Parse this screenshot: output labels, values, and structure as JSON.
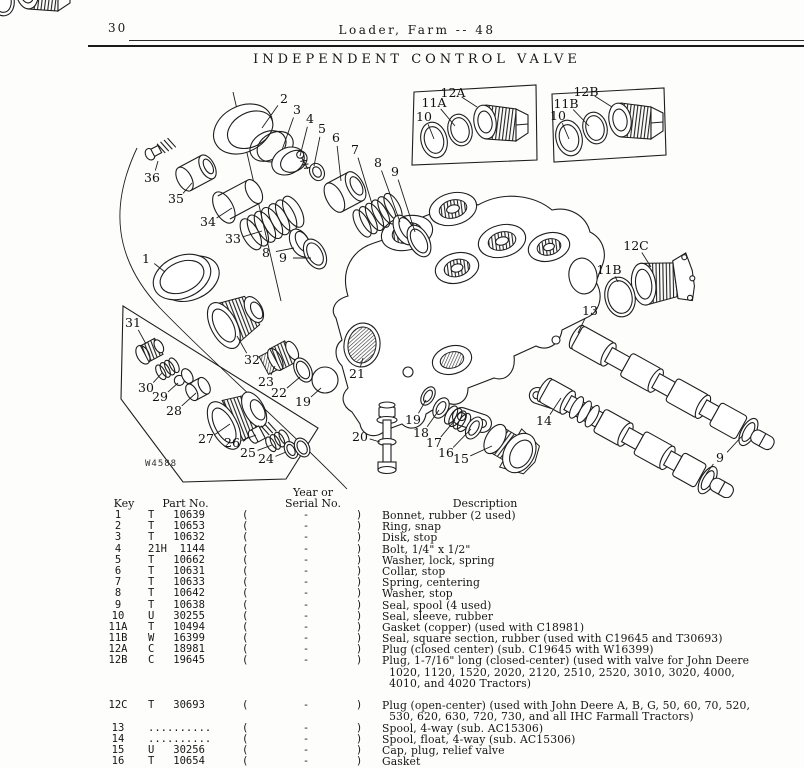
{
  "header": {
    "page_number": "30",
    "title": "Loader, Farm -- 48",
    "subtitle": "INDEPENDENT CONTROL VALVE"
  },
  "figure": {
    "figure_number": "W4588",
    "labels": [
      {
        "t": "2",
        "x": 284,
        "y": 103,
        "tx": 262,
        "ty": 128
      },
      {
        "t": "3",
        "x": 297,
        "y": 114,
        "tx": 282,
        "ty": 150
      },
      {
        "t": "4",
        "x": 310,
        "y": 123,
        "tx": 300,
        "ty": 156
      },
      {
        "t": "5",
        "x": 322,
        "y": 133,
        "tx": 314,
        "ty": 166
      },
      {
        "t": "6",
        "x": 336,
        "y": 142,
        "tx": 341,
        "ty": 181
      },
      {
        "t": "7",
        "x": 355,
        "y": 154,
        "tx": 372,
        "ty": 204
      },
      {
        "t": "8",
        "x": 378,
        "y": 167,
        "tx": 400,
        "ty": 222
      },
      {
        "t": "9",
        "x": 395,
        "y": 176,
        "tx": 415,
        "ty": 232
      },
      {
        "t": "36",
        "x": 152,
        "y": 182,
        "tx": 158,
        "ty": 161
      },
      {
        "t": "35",
        "x": 176,
        "y": 203,
        "tx": 192,
        "ty": 183
      },
      {
        "t": "34",
        "x": 208,
        "y": 226,
        "tx": 232,
        "ty": 208
      },
      {
        "t": "33",
        "x": 233,
        "y": 243,
        "tx": 262,
        "ty": 231
      },
      {
        "t": "8",
        "x": 266,
        "y": 257,
        "tx": 294,
        "ty": 248
      },
      {
        "t": "9",
        "x": 283,
        "y": 262,
        "tx": 311,
        "ty": 258
      },
      {
        "t": "1",
        "x": 146,
        "y": 263,
        "tx": 165,
        "ty": 272
      },
      {
        "t": "31",
        "x": 133,
        "y": 327,
        "tx": 146,
        "ty": 344
      },
      {
        "t": "30",
        "x": 146,
        "y": 392,
        "tx": 162,
        "ty": 373
      },
      {
        "t": "29",
        "x": 160,
        "y": 401,
        "tx": 178,
        "ty": 383
      },
      {
        "t": "28",
        "x": 174,
        "y": 415,
        "tx": 196,
        "ty": 393
      },
      {
        "t": "27",
        "x": 206,
        "y": 443,
        "tx": 230,
        "ty": 424
      },
      {
        "t": "26",
        "x": 232,
        "y": 447,
        "tx": 256,
        "ty": 435
      },
      {
        "t": "25",
        "x": 248,
        "y": 457,
        "tx": 272,
        "ty": 445
      },
      {
        "t": "24",
        "x": 266,
        "y": 463,
        "tx": 286,
        "ty": 452
      },
      {
        "t": "32",
        "x": 252,
        "y": 364,
        "tx": 237,
        "ty": 336
      },
      {
        "t": "23",
        "x": 266,
        "y": 386,
        "tx": 275,
        "ty": 366
      },
      {
        "t": "22",
        "x": 279,
        "y": 397,
        "tx": 300,
        "ty": 377
      },
      {
        "t": "19",
        "x": 303,
        "y": 406,
        "tx": 321,
        "ty": 388
      },
      {
        "t": "21",
        "x": 357,
        "y": 378,
        "tx": 363,
        "ty": 358
      },
      {
        "t": "20",
        "x": 360,
        "y": 441,
        "tx": 380,
        "ty": 442
      },
      {
        "t": "19",
        "x": 413,
        "y": 424,
        "tx": 426,
        "ty": 400
      },
      {
        "t": "18",
        "x": 421,
        "y": 437,
        "tx": 439,
        "ty": 410
      },
      {
        "t": "17",
        "x": 434,
        "y": 447,
        "tx": 455,
        "ty": 420
      },
      {
        "t": "16",
        "x": 446,
        "y": 457,
        "tx": 471,
        "ty": 429
      },
      {
        "t": "15",
        "x": 461,
        "y": 463,
        "tx": 492,
        "ty": 446
      },
      {
        "t": "14",
        "x": 544,
        "y": 425,
        "tx": 561,
        "ty": 398
      },
      {
        "t": "13",
        "x": 590,
        "y": 315,
        "tx": 578,
        "ty": 333
      },
      {
        "t": "11B",
        "x": 609,
        "y": 274,
        "tx": 618,
        "ty": 282
      },
      {
        "t": "12C",
        "x": 636,
        "y": 250,
        "tx": 651,
        "ty": 267
      },
      {
        "t": "9",
        "x": 720,
        "y": 462,
        "tx": 743,
        "ty": 435
      },
      {
        "t": "",
        "x": 720,
        "y": 462,
        "tx": 706,
        "ty": 474
      },
      {
        "t": "10",
        "x": 424,
        "y": 121,
        "tx": 434,
        "ty": 139
      },
      {
        "t": "11A",
        "x": 434,
        "y": 107,
        "tx": 455,
        "ty": 126
      },
      {
        "t": "12A",
        "x": 453,
        "y": 97,
        "tx": 477,
        "ty": 107
      },
      {
        "t": "10",
        "x": 558,
        "y": 120,
        "tx": 569,
        "ty": 139
      },
      {
        "t": "11B",
        "x": 566,
        "y": 108,
        "tx": 589,
        "ty": 126
      },
      {
        "t": "12B",
        "x": 586,
        "y": 96,
        "tx": 612,
        "ty": 107
      }
    ]
  },
  "table": {
    "header": {
      "key": "Key",
      "part": "Part No.",
      "year1": "Year or",
      "year2": "Serial No.",
      "desc": "Description"
    },
    "rows": [
      {
        "key": "1",
        "part": "T   10639",
        "p1": "(",
        "dash": "-",
        "p2": ")",
        "desc": "Bonnet, rubber (2 used)"
      },
      {
        "key": "2",
        "part": "T   10653",
        "p1": "(",
        "dash": "-",
        "p2": ")",
        "desc": "Ring, snap"
      },
      {
        "key": "3",
        "part": "T   10632",
        "p1": "(",
        "dash": "-",
        "p2": ")",
        "desc": "Disk, stop"
      },
      {
        "key": "4",
        "part": "21H  1144",
        "p1": "(",
        "dash": "-",
        "p2": ")",
        "desc": "Bolt, 1/4\" x 1/2\""
      },
      {
        "key": "5",
        "part": "T   10662",
        "p1": "(",
        "dash": "-",
        "p2": ")",
        "desc": "Washer, lock, spring"
      },
      {
        "key": "6",
        "part": "T   10631",
        "p1": "(",
        "dash": "-",
        "p2": ")",
        "desc": "Collar, stop"
      },
      {
        "key": "7",
        "part": "T   10633",
        "p1": "(",
        "dash": "-",
        "p2": ")",
        "desc": "Spring, centering"
      },
      {
        "key": "8",
        "part": "T   10642",
        "p1": "(",
        "dash": "-",
        "p2": ")",
        "desc": "Washer, stop"
      },
      {
        "key": "9",
        "part": "T   10638",
        "p1": "(",
        "dash": "-",
        "p2": ")",
        "desc": "Seal, spool (4 used)"
      },
      {
        "key": "10",
        "part": "U   30255",
        "p1": "(",
        "dash": "-",
        "p2": ")",
        "desc": "Seal, sleeve, rubber"
      },
      {
        "key": "11A",
        "part": "T   10494",
        "p1": "(",
        "dash": "-",
        "p2": ")",
        "desc": "Gasket (copper) (used with C18981)"
      },
      {
        "key": "11B",
        "part": "W   16399",
        "p1": "(",
        "dash": "-",
        "p2": ")",
        "desc": "Seal, square section, rubber (used with C19645 and T30693)"
      },
      {
        "key": "12A",
        "part": "C   18981",
        "p1": "(",
        "dash": "-",
        "p2": ")",
        "desc": "Plug (closed center) (sub. C19645 with W16399)"
      },
      {
        "key": "12B",
        "part": "C   19645",
        "p1": "(",
        "dash": "-",
        "p2": ")",
        "desc": "Plug, 1-7/16\" long (closed-center) (used with valve for John Deere"
      },
      {
        "key": "",
        "part": "",
        "p1": "",
        "dash": "",
        "p2": "",
        "desc": "  1020, 1120, 1520, 2020, 2120, 2510, 2520, 3010, 3020, 4000,"
      },
      {
        "key": "",
        "part": "",
        "p1": "",
        "dash": "",
        "p2": "",
        "desc": "  4010, and 4020 Tractors)"
      },
      {
        "key": "",
        "part": "",
        "p1": "",
        "dash": "",
        "p2": "",
        "desc": ""
      },
      {
        "key": "12C",
        "part": "T   30693",
        "p1": "(",
        "dash": "-",
        "p2": ")",
        "desc": "Plug (open-center) (used with John Deere A, B, G, 50, 60, 70, 520,"
      },
      {
        "key": "",
        "part": "",
        "p1": "",
        "dash": "",
        "p2": "",
        "desc": "  530, 620, 630, 720, 730, and all IHC Farmall Tractors)"
      },
      {
        "key": "13",
        "part": "..........",
        "p1": "(",
        "dash": "-",
        "p2": ")",
        "desc": "Spool, 4-way (sub. AC15306)"
      },
      {
        "key": "14",
        "part": "..........",
        "p1": "(",
        "dash": "-",
        "p2": ")",
        "desc": "Spool, float, 4-way (sub. AC15306)"
      },
      {
        "key": "15",
        "part": "U   30256",
        "p1": "(",
        "dash": "-",
        "p2": ")",
        "desc": "Cap, plug, relief valve"
      },
      {
        "key": "16",
        "part": "T   10654",
        "p1": "(",
        "dash": "-",
        "p2": ")",
        "desc": "Gasket"
      }
    ]
  }
}
